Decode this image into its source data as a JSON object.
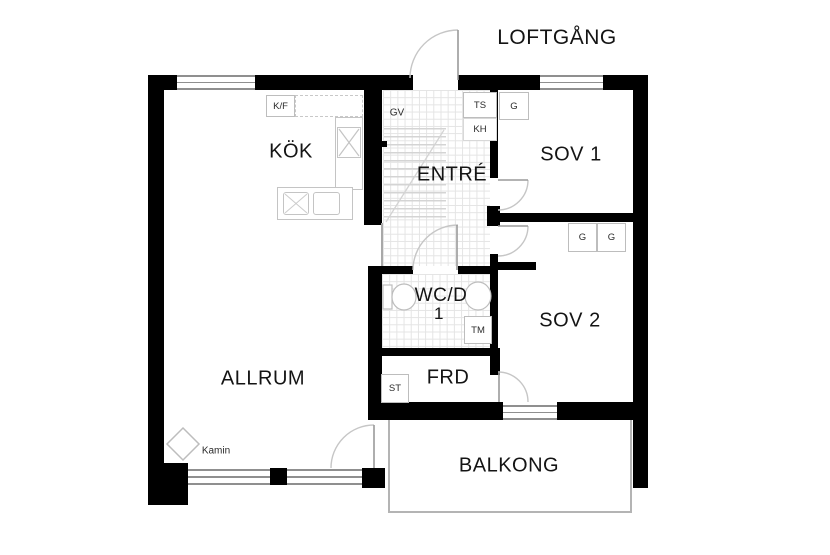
{
  "plan": {
    "outside_label": "LOFTGÅNG",
    "rooms": [
      {
        "id": "kok",
        "label": "KÖK"
      },
      {
        "id": "entre",
        "label": "ENTRÉ"
      },
      {
        "id": "sov1",
        "label": "SOV 1"
      },
      {
        "id": "sov2",
        "label": "SOV 2"
      },
      {
        "id": "wcd",
        "label": "WC/D",
        "label2": "1"
      },
      {
        "id": "frd",
        "label": "FRD"
      },
      {
        "id": "allrum",
        "label": "ALLRUM"
      },
      {
        "id": "balkong",
        "label": "BALKONG"
      }
    ],
    "fixtures": {
      "kf": "K/F",
      "gv": "GV",
      "ts": "TS",
      "kh": "KH",
      "g_sov1": "G",
      "g_sov2_left": "G",
      "g_sov2_right": "G",
      "tm": "TM",
      "st": "ST",
      "kamin": "Kamin"
    },
    "colors": {
      "wall": "#000000",
      "window_line": "#8f8f8f",
      "door_line": "#c6c6c6",
      "fixture_line": "#bdbdbd",
      "tile_line": "#e4e4e4",
      "text": "#141414",
      "background": "#ffffff"
    }
  }
}
